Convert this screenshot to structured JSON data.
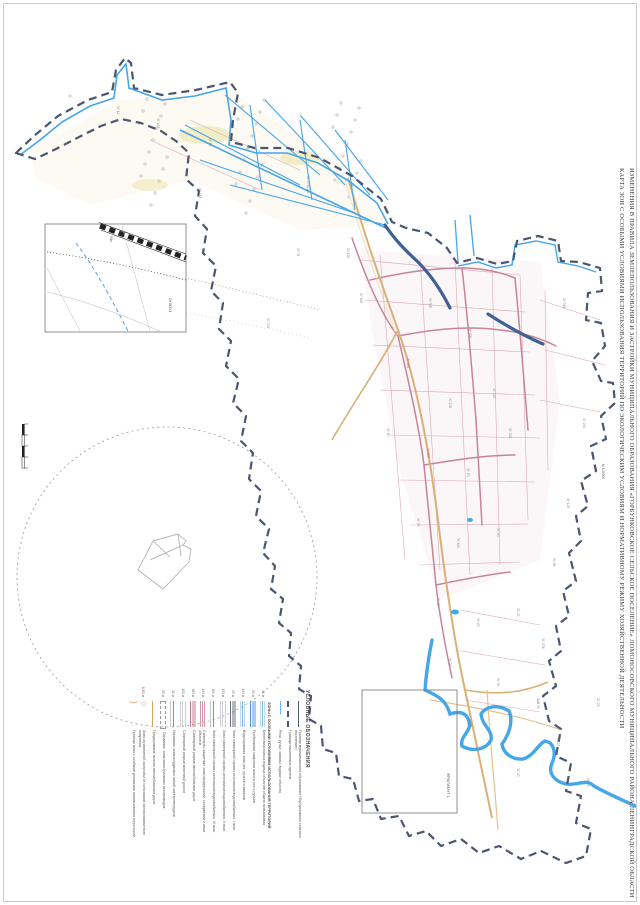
{
  "title": {
    "line1": "ИЗМЕНЕНИЯ В ПРАВИЛА ЗЕМЛЕПОЛЬЗОВАНИЯ И ЗАСТРОЙКИ МУНИЦИПАЛЬНОГО ОБРАЗОВАНИЯ «ГОРБУНКОВСКОЕ СЕЛЬСКОЕ ПОСЕЛЕНИЕ» ЛОМОНОСОВСКОГО МУНИЦИПАЛЬНОГО РАЙОНА ЛЕНИНГРАДСКОЙ ОБЛАСТИ",
    "line2": "КАРТА ЗОН С ОСОБЫМИ УСЛОВИЯМИ ИСПОЛЬЗОВАНИЯ ТЕРРИТОРИЙ ПО ЭКОЛОГИЧЕСКИМ УСЛОВИЯМ И НОРМАТИВНОМУ РЕЖИМУ ХОЗЯЙСТВЕННОЙ ДЕЯТЕЛЬНОСТИ",
    "scale_note": "М 1:25000"
  },
  "legend": {
    "heading": "УСЛОВНЫЕ ОБОЗНАЧЕНИЯ",
    "subheading": "ЗОНЫ С ОСОБЫМИ УСЛОВИЯМИ ИСПОЛЬЗОВАНИЯ ТЕРРИТОРИЙ",
    "items": [
      {
        "code": "",
        "swatch": "sw-line-thin",
        "label": "Граница муниципального образования «Горбунковское сельское поселение»"
      },
      {
        "code": "",
        "swatch": "sw-line-dash",
        "label": "Границы населённых пунктов"
      },
      {
        "code": "",
        "swatch": "sw-river",
        "label": "Реки, ручьи, каналы, водные объекты"
      },
      {
        "code": "20 м",
        "swatch": "sw-hatch-blue",
        "label": "Береговая полоса водных объектов общего пользования"
      },
      {
        "code": "50 м",
        "swatch": "sw-hatch-blue-d",
        "label": "Прибрежная защитная полоса рек и ручьёв"
      },
      {
        "code": "100 м",
        "swatch": "sw-hatch-blue",
        "label": "Водоохранная зона рек, ручьёв и каналов"
      },
      {
        "code": "50 м",
        "swatch": "sw-hatch-dark",
        "label": "Зона санитарной охраны источников водоснабжения, I пояс"
      },
      {
        "code": "150 м",
        "swatch": "sw-hatch-gray",
        "label": "Зона санитарной охраны источников водоснабжения, II пояс"
      },
      {
        "code": "300 м",
        "swatch": "sw-lines-sparse",
        "label": "Зона санитарной охраны источников водоснабжения, III пояс"
      },
      {
        "code": "100 м",
        "swatch": "sw-hatch-pink",
        "label": "Санитарно-защитные зоны предприятий, сооружений и иных объектов"
      },
      {
        "code": "300 м",
        "swatch": "sw-hatch-pink-d",
        "label": "Санитарный разрыв автомобильных дорог"
      },
      {
        "code": "100 м",
        "swatch": "sw-hatch-gray",
        "label": "Санитарный разрыв железной дороги"
      },
      {
        "code": "25 м",
        "swatch": "sw-lines-sparse",
        "label": "Охранные зоны воздушных линий электропередачи"
      },
      {
        "code": "25 м",
        "swatch": "sw-rect-dashed",
        "label": "Охранные зоны магистральных газопроводов"
      },
      {
        "code": "",
        "swatch": "sw-line-orange",
        "label": "Придорожные полосы автомобильных дорог"
      },
      {
        "code": "1000 м",
        "swatch": "sw-diamond",
        "label": "Зона ограничений застройки от источников электромагнитного излучения"
      },
      {
        "code": "",
        "swatch": "sw-bracket",
        "label": "Граница зоны с особыми условиями использования территории"
      }
    ]
  },
  "insets": {
    "detail_label": "ОУ ВОЗ.1",
    "detail_road_label": "50м",
    "fragment_label": "ФРАГМЕНТ 1"
  },
  "map_labels": [
    {
      "t": "ЗУ 127",
      "x": 160,
      "y": 118,
      "c": ""
    },
    {
      "t": "ЗУ 14",
      "x": 120,
      "y": 106,
      "c": ""
    },
    {
      "t": "ЗУ 85",
      "x": 212,
      "y": 138,
      "c": ""
    },
    {
      "t": "ЗУ 2700 АВ",
      "x": 310,
      "y": 176,
      "c": ""
    },
    {
      "t": "ЗУ 183",
      "x": 202,
      "y": 188,
      "c": ""
    },
    {
      "t": "ЗУ 51",
      "x": 300,
      "y": 248,
      "c": ""
    },
    {
      "t": "ЗУ 254",
      "x": 270,
      "y": 318,
      "c": ""
    },
    {
      "t": "ЗУ 150",
      "x": 350,
      "y": 248,
      "c": "pink"
    },
    {
      "t": "ЗУ 600",
      "x": 363,
      "y": 293,
      "c": ""
    },
    {
      "t": "ЗУ 300",
      "x": 432,
      "y": 298,
      "c": ""
    },
    {
      "t": "ЗУ 500",
      "x": 472,
      "y": 328,
      "c": ""
    },
    {
      "t": "ЗУ 318",
      "x": 566,
      "y": 298,
      "c": ""
    },
    {
      "t": "ЗУ 600",
      "x": 410,
      "y": 358,
      "c": "pink"
    },
    {
      "t": "ЗУ 100",
      "x": 452,
      "y": 398,
      "c": ""
    },
    {
      "t": "ЗУ 120",
      "x": 496,
      "y": 388,
      "c": ""
    },
    {
      "t": "ЗУ 254",
      "x": 586,
      "y": 418,
      "c": ""
    },
    {
      "t": "ЗУ 60",
      "x": 390,
      "y": 428,
      "c": ""
    },
    {
      "t": "ЗУ 640",
      "x": 430,
      "y": 448,
      "c": "pink"
    },
    {
      "t": "ЗУ 50",
      "x": 470,
      "y": 468,
      "c": ""
    },
    {
      "t": "ЗУ 320",
      "x": 512,
      "y": 428,
      "c": ""
    },
    {
      "t": "ЗУ 25",
      "x": 420,
      "y": 518,
      "c": ""
    },
    {
      "t": "ЗУ 640",
      "x": 460,
      "y": 538,
      "c": ""
    },
    {
      "t": "ЗУ 30",
      "x": 500,
      "y": 528,
      "c": ""
    },
    {
      "t": "ЗУ 129",
      "x": 570,
      "y": 498,
      "c": ""
    },
    {
      "t": "ЗУ 86",
      "x": 556,
      "y": 558,
      "c": ""
    },
    {
      "t": "ЗУ 20",
      "x": 440,
      "y": 598,
      "c": ""
    },
    {
      "t": "ЗУ 45",
      "x": 480,
      "y": 618,
      "c": ""
    },
    {
      "t": "ЗУ 25",
      "x": 520,
      "y": 608,
      "c": ""
    },
    {
      "t": "ЗУ 2ПК",
      "x": 545,
      "y": 638,
      "c": ""
    },
    {
      "t": "ЗУ 20",
      "x": 452,
      "y": 658,
      "c": ""
    },
    {
      "t": "ЗУ 30",
      "x": 500,
      "y": 678,
      "c": ""
    },
    {
      "t": "ЗАВ 30",
      "x": 540,
      "y": 698,
      "c": ""
    },
    {
      "t": "ЗУ 20",
      "x": 470,
      "y": 718,
      "c": ""
    },
    {
      "t": "ЗУ 25",
      "x": 560,
      "y": 738,
      "c": ""
    },
    {
      "t": "ЗУ 20",
      "x": 520,
      "y": 768,
      "c": ""
    },
    {
      "t": "ЗУ 23",
      "x": 590,
      "y": 778,
      "c": ""
    },
    {
      "t": "ЗУ 23",
      "x": 600,
      "y": 698,
      "c": ""
    },
    {
      "t": "50м",
      "x": 113,
      "y": 236,
      "c": "dark"
    },
    {
      "t": "ОУ ВОЗ.1",
      "x": 172,
      "y": 298,
      "c": "dark"
    },
    {
      "t": "ФРАГМЕНТ 1",
      "x": 451,
      "y": 773,
      "c": "dark",
      "fs": 4
    },
    {
      "t": "М 1:25000",
      "x": 605,
      "y": 464,
      "c": "dark"
    }
  ],
  "colors": {
    "boundary": "#4a5670",
    "water": "#45a6e8",
    "navy": "#3f5f95",
    "pink": "#dba8b4",
    "pink_dark": "#c8849a",
    "road": "#d9b078",
    "circle": "#9a9a9a",
    "legend_text": "#5a5a5a"
  }
}
